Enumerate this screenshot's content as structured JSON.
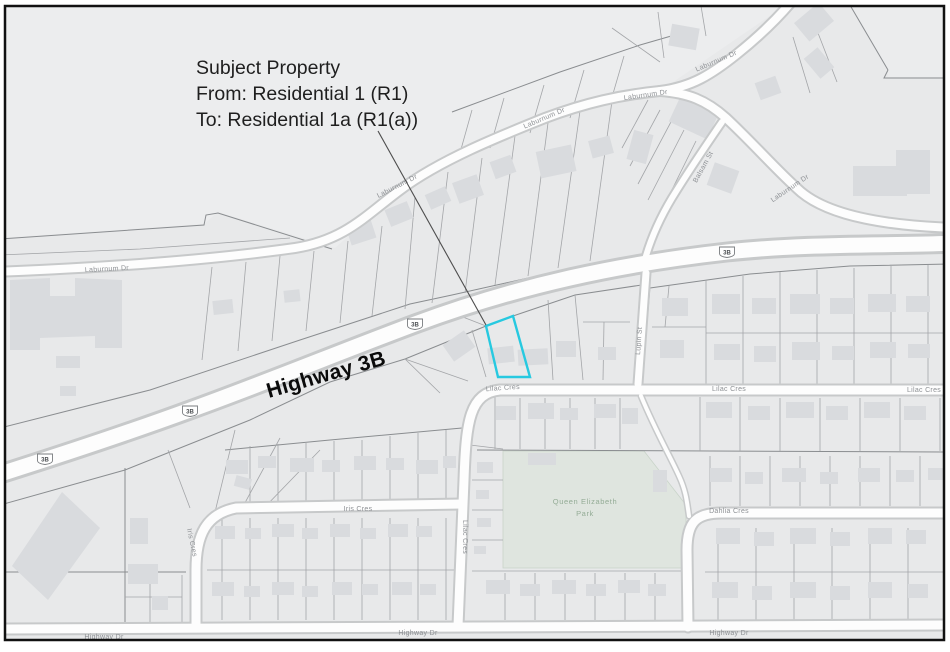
{
  "annotation": {
    "lines": [
      "Subject Property",
      "From: Residential 1 (R1)",
      "To: Residential 1a (R1(a))"
    ]
  },
  "highway_label": "Highway 3B",
  "shield": "3B",
  "park": {
    "line1": "Queen Elizabeth",
    "line2": "Park"
  },
  "streets": [
    {
      "name": "laburnum-dr-west",
      "text": "Laburnum Dr"
    },
    {
      "name": "laburnum-dr-mid1",
      "text": "Laburnum Dr"
    },
    {
      "name": "laburnum-dr-mid2",
      "text": "Laburnum Dr"
    },
    {
      "name": "laburnum-dr-east1",
      "text": "Laburnum Dr"
    },
    {
      "name": "laburnum-dr-upper",
      "text": "Laburnum Dr"
    },
    {
      "name": "laburnum-dr-lower",
      "text": "Laburnum Dr"
    },
    {
      "name": "balsam-st",
      "text": "Balsam St"
    },
    {
      "name": "lilac-cres-west",
      "text": "Lilac Cres"
    },
    {
      "name": "lilac-cres-mid",
      "text": "Lilac Cres"
    },
    {
      "name": "lilac-cres-east",
      "text": "Lilac Cres"
    },
    {
      "name": "lilac-cres-vertical",
      "text": "Lilac Cres"
    },
    {
      "name": "lupin-st",
      "text": "Lupin St"
    },
    {
      "name": "iris-cres-horizontal",
      "text": "Iris Cres"
    },
    {
      "name": "iris-cres-vertical",
      "text": "Iris Cres"
    },
    {
      "name": "dahlia-cres",
      "text": "Dahlia Cres"
    },
    {
      "name": "highway-dr-west",
      "text": "Highway Dr"
    },
    {
      "name": "highway-dr-mid",
      "text": "Highway Dr"
    },
    {
      "name": "highway-dr-east",
      "text": "Highway Dr"
    }
  ],
  "colors": {
    "highlight": "#27c9e0",
    "background": "#e8e9ea",
    "park_fill": "#dfe5df",
    "park_text": "#94ac96",
    "road_fill": "#fdfdfd",
    "road_casing": "#c7c9ca",
    "building": "#d9dbde",
    "parcel_line": "#a3a5a8",
    "street_label": "#8d9094",
    "annotation_text": "#1f1f1f"
  }
}
